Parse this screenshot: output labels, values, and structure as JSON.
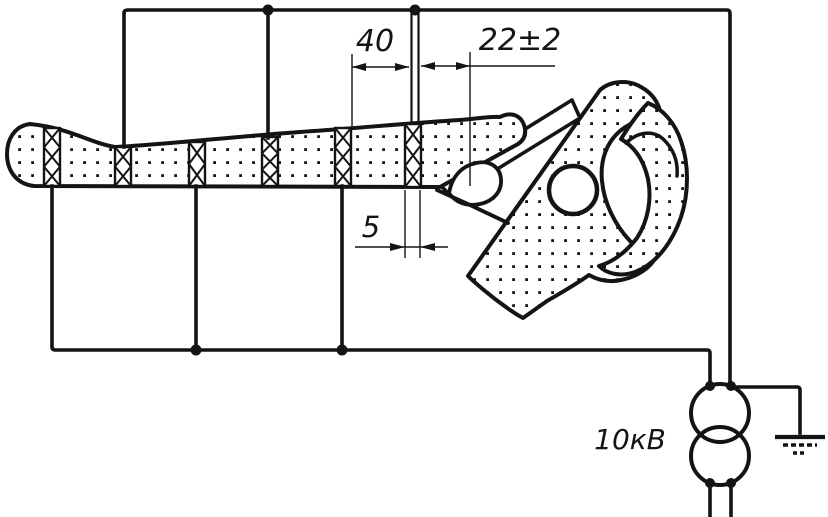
{
  "labels": {
    "dim_band_gap": "40",
    "dim_head_clearance": "22±2",
    "dim_band_width": "5",
    "voltage": "10кВ"
  },
  "colors": {
    "ink": "#141414",
    "paper": "#ffffff"
  },
  "icons": {
    "transformer": "hv-transformer-symbol",
    "ground": "earth-ground-icon",
    "electrode_band": "crosshatch-electrode-band"
  }
}
